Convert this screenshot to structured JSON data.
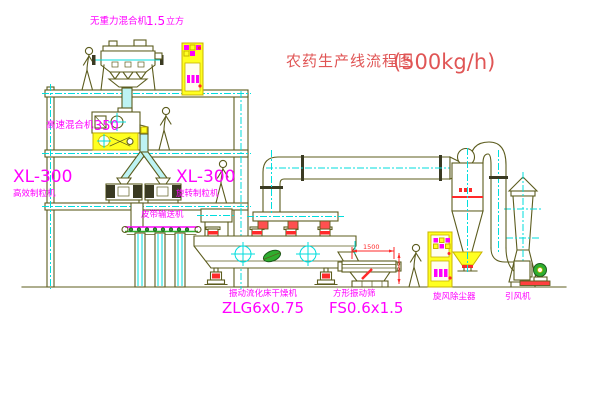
{
  "title": {
    "name": "农药生产线流程图",
    "capacity": "(500kg/h)"
  },
  "labels": {
    "mixer_top_name": "无重力混合机",
    "mixer_top_value": "1.5",
    "mixer_top_unit": "立方",
    "mixer_hs_name": "高速混合机",
    "mixer_hs_value": "350",
    "granulator_left_model": "XL-300",
    "granulator_left_name": "高效制粒机",
    "granulator_right_model": "XL-300",
    "granulator_right_name": "旋转制粒机",
    "conveyor": "皮带输送机",
    "dryer_name": "振动流化床干燥机",
    "dryer_model": "ZLG6x0.75",
    "screen_name": "方形振动筛",
    "screen_model": "FS0.6x1.5",
    "cyclone": "旋风除尘器",
    "fan": "引风机"
  },
  "dimensions": {
    "screen_length": "1500"
  },
  "colors": {
    "drawing_line": "#5c5c1e",
    "centerline_cyan": "#00dede",
    "label_magenta": "#ff00ff",
    "title_red": "#e05555",
    "panel_yellow": "#ffff21",
    "alert_red": "#ff2a2a",
    "machine_green": "#2fae2f"
  }
}
